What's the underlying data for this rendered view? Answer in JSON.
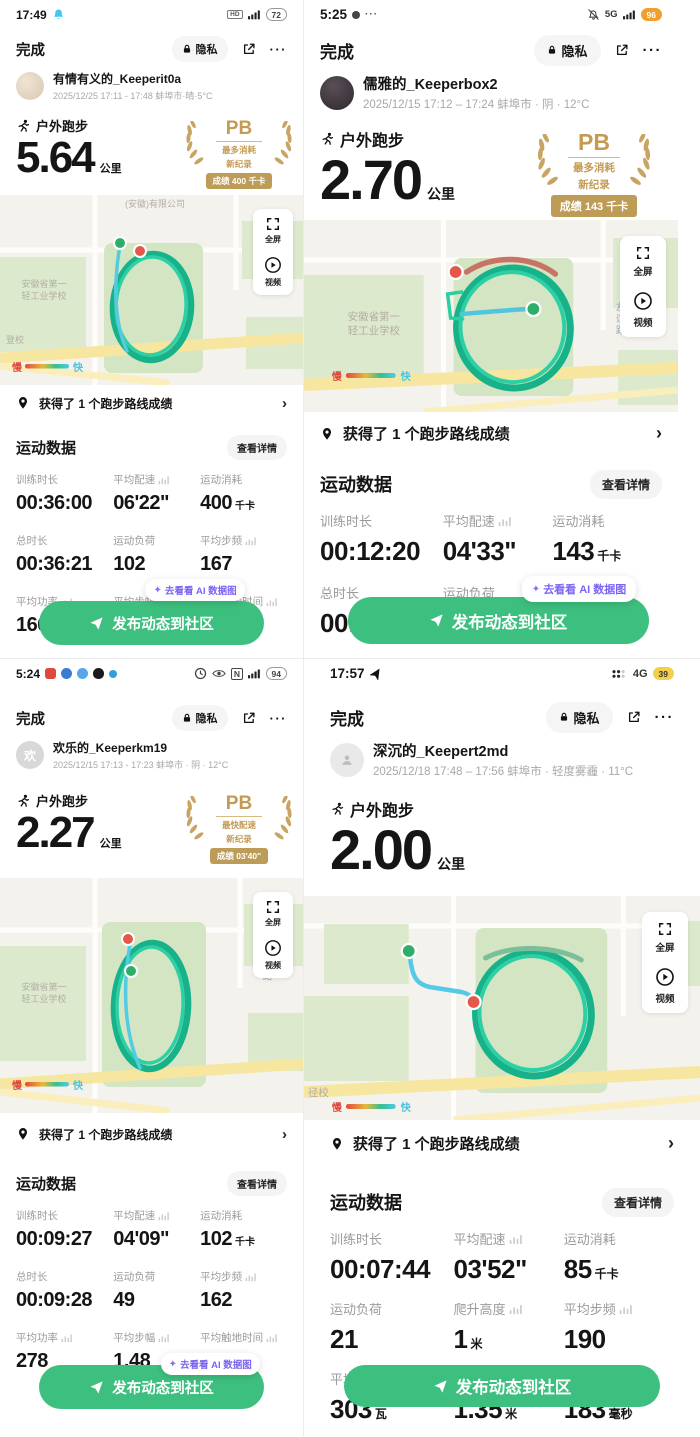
{
  "app": {
    "done": "完成",
    "privacy": "隐私",
    "activity_type": "户外跑步",
    "distance_unit": "公里",
    "pb_title": "PB",
    "record_line": "新纪录",
    "route_achievement": "获得了 1 个跑步路线成绩",
    "data_title": "运动数据",
    "view_details": "查看详情",
    "cta_label": "发布动态到社区",
    "ai_tooltip": "去看看 AI 数据图",
    "legend_slow": "慢",
    "legend_fast": "快",
    "fullscreen": "全屏",
    "video": "视频",
    "map_school1": "安徽省第一",
    "map_school2": "轻工业学校",
    "map_road": "友谊路"
  },
  "colors": {
    "cta_green": "#3dc07f",
    "pb_gold": "#c49a55",
    "route_teal": "#17b28a",
    "route_blue": "#54cbe0",
    "start_green": "#2fae69",
    "end_red": "#e4574b",
    "tooltip_purple": "#7d63f2"
  },
  "quadrants": [
    {
      "status": {
        "time": "17:49",
        "badge": "HD",
        "battery": "72"
      },
      "user": {
        "name": "有情有义的_Keeperit0a",
        "meta": "2025/12/25 17:11 - 17:48 蚌埠市·晴·5°C"
      },
      "distance": "5.64",
      "pb": {
        "line1": "最多消耗",
        "score": "成绩 400 千卡"
      },
      "map": {
        "company": "(安徽)有限公司",
        "corner": "登校"
      },
      "stats": [
        {
          "label": "训练时长",
          "value": "00:36:00",
          "unit": ""
        },
        {
          "label": "平均配速",
          "value": "06'22\"",
          "unit": ""
        },
        {
          "label": "运动消耗",
          "value": "400",
          "unit": "千卡"
        },
        {
          "label": "总时长",
          "value": "00:36:21",
          "unit": ""
        },
        {
          "label": "运动负荷",
          "value": "102",
          "unit": ""
        },
        {
          "label": "平均步频",
          "value": "167",
          "unit": ""
        },
        {
          "label": "平均功率",
          "value": "166",
          "unit": ""
        },
        {
          "label": "平均步幅",
          "value": "",
          "unit": ""
        },
        {
          "label": "平均触地时间",
          "value": "",
          "unit": "毫秒"
        }
      ]
    },
    {
      "status": {
        "time": "5:25",
        "net": "5G",
        "battery": "96"
      },
      "user": {
        "name": "儒雅的_Keeperbox2",
        "meta": "2025/12/15 17:12 – 17:24 蚌埠市 · 阴 · 12°C"
      },
      "distance": "2.70",
      "pb": {
        "line1": "最多消耗",
        "score": "成绩 143 千卡"
      },
      "stats": [
        {
          "label": "训练时长",
          "value": "00:12:20",
          "unit": ""
        },
        {
          "label": "平均配速",
          "value": "04'33\"",
          "unit": ""
        },
        {
          "label": "运动消耗",
          "value": "143",
          "unit": "千卡"
        },
        {
          "label": "总时长",
          "value": "00:12:21",
          "unit": ""
        },
        {
          "label": "运动负荷",
          "value": "19",
          "unit": ""
        },
        {
          "label": "平均步频",
          "value": "84",
          "unit": ""
        },
        {
          "label": "平均功率",
          "value": "207",
          "unit": ""
        },
        {
          "label": "平均步幅",
          "value": "",
          "unit": ""
        },
        {
          "label": "平均触地时间",
          "value": "",
          "unit": "毫秒"
        }
      ]
    },
    {
      "status": {
        "time": "5:24",
        "battery": "94"
      },
      "user": {
        "name": "欢乐的_Keeperkm19",
        "meta": "2025/12/15 17:13 - 17:23 蚌埠市 · 阴 · 12°C",
        "avatar_char": "欢"
      },
      "distance": "2.27",
      "pb": {
        "line1": "最快配速",
        "score": "成绩 03'40\""
      },
      "stats": [
        {
          "label": "训练时长",
          "value": "00:09:27",
          "unit": ""
        },
        {
          "label": "平均配速",
          "value": "04'09\"",
          "unit": ""
        },
        {
          "label": "运动消耗",
          "value": "102",
          "unit": "千卡"
        },
        {
          "label": "总时长",
          "value": "00:09:28",
          "unit": ""
        },
        {
          "label": "运动负荷",
          "value": "49",
          "unit": ""
        },
        {
          "label": "平均步频",
          "value": "162",
          "unit": ""
        },
        {
          "label": "平均功率",
          "value": "278",
          "unit": ""
        },
        {
          "label": "平均步幅",
          "value": "1.48",
          "unit": ""
        },
        {
          "label": "平均触地时间",
          "value": "",
          "unit": "毫秒"
        }
      ]
    },
    {
      "status": {
        "time": "17:57",
        "net": "4G",
        "battery": "39"
      },
      "user": {
        "name": "深沉的_Keepert2md",
        "meta": "2025/12/18 17:48 – 17:56 蚌埠市 · 轻度雾霾 · 11°C"
      },
      "distance": "2.00",
      "map": {
        "corner": "径校"
      },
      "trend": {
        "title": "运动趋势",
        "details": "查看详情"
      },
      "stats": [
        {
          "label": "训练时长",
          "value": "00:07:44",
          "unit": ""
        },
        {
          "label": "平均配速",
          "value": "03'52\"",
          "unit": ""
        },
        {
          "label": "运动消耗",
          "value": "85",
          "unit": "千卡"
        },
        {
          "label": "运动负荷",
          "value": "21",
          "unit": ""
        },
        {
          "label": "爬升高度",
          "value": "1",
          "unit": "米"
        },
        {
          "label": "平均步频",
          "value": "190",
          "unit": ""
        },
        {
          "label": "平均功率",
          "value": "303",
          "unit": "瓦"
        },
        {
          "label": "平均步幅",
          "value": "1.35",
          "unit": "米"
        },
        {
          "label": "平均触地时间",
          "value": "183",
          "unit": "毫秒"
        }
      ]
    }
  ]
}
